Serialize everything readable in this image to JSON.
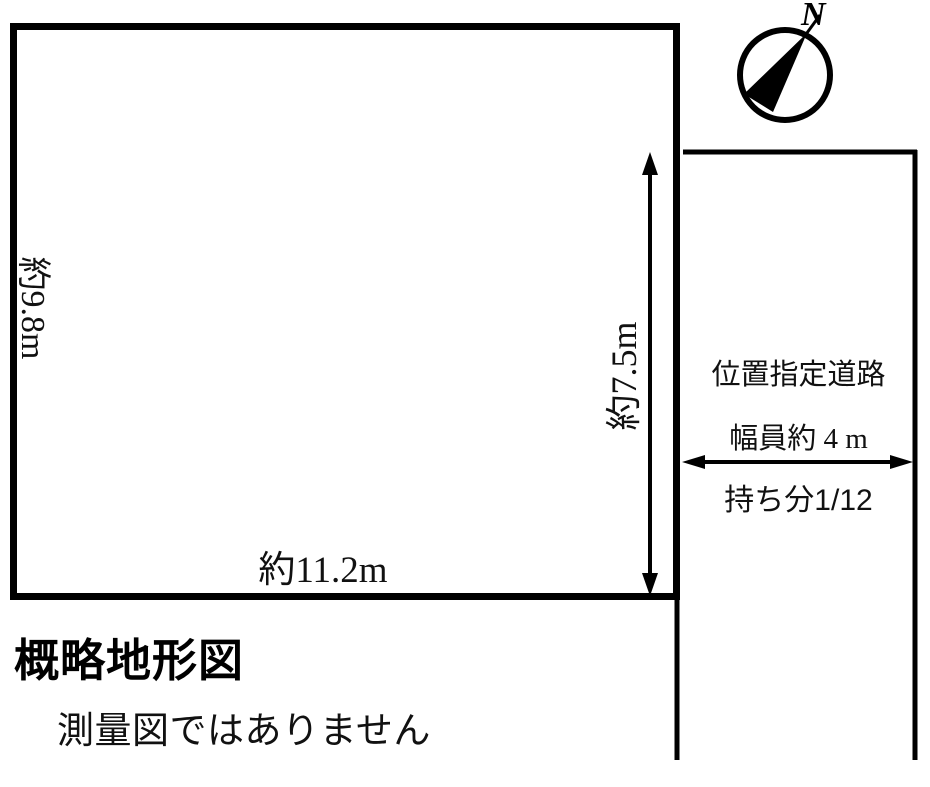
{
  "figure": {
    "title": "概略地形図",
    "disclaimer": "測量図ではありません"
  },
  "plot": {
    "left_dimension": "約9.8m",
    "right_dimension": "約7.5m",
    "bottom_dimension": "約11.2m"
  },
  "road": {
    "name": "位置指定道路",
    "width_note": "幅員約 4 m",
    "share_prefix": "持ち分",
    "share_value": "1/12"
  },
  "compass": {
    "north_label": "N"
  },
  "colors": {
    "ink": "#000000",
    "background": "#ffffff"
  }
}
